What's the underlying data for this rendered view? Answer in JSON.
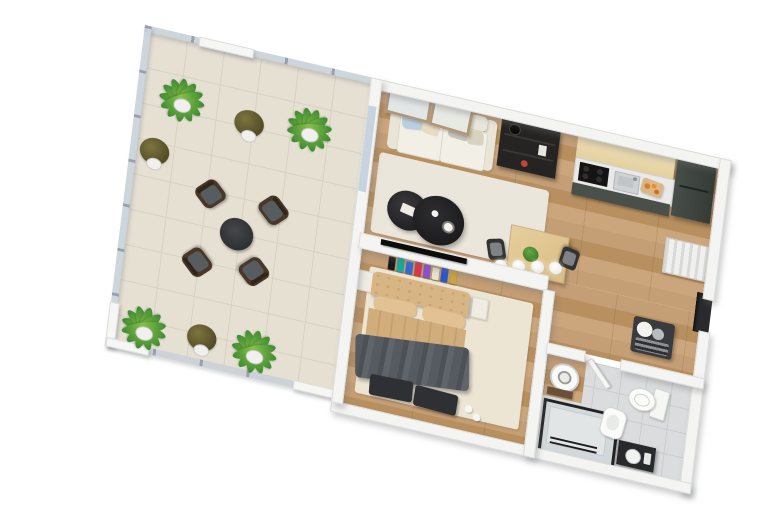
{
  "scene": {
    "kind": "3d-floor-plan-render",
    "view": "isometric top-down, plan rotated ~13 degrees clockwise",
    "background": "#ffffff",
    "no_visible_text": true
  },
  "palette": {
    "wall_white": "#f4f4f2",
    "terrace_tile": "#e6e0d3",
    "glass_railing": "#c9d1d9",
    "railing_post": "#97a1ab",
    "wood_floor": "#c09a6f",
    "bath_tile": "#dadcdd",
    "sofa_cream": "#f2efe7",
    "pillow_blue": "#b9cfdd",
    "rug_light": "#eae6db",
    "coffee_table_black": "#2a2a2c",
    "kitchen_upper_wood": "#ead9ad",
    "kitchen_cabinet_green": "#49504a",
    "fridge_dark": "#3c423d",
    "dining_wood": "#e0c794",
    "bed_tan": "#d5b081",
    "blanket_gray": "#565b61",
    "fixture_white": "#fafafa",
    "vanity_dark": "#28292b",
    "plant_green": "#4e9b3e",
    "accent_food_orange": "#e07a2a"
  },
  "rooms": {
    "terrace": {
      "label": "Terrace",
      "floor": "beige tile",
      "enclosure": "glass railing with metal posts and white wall stubs",
      "furniture": [
        "4 large green potted plants",
        "3 small brown potted plants",
        "4 dark wicker armchairs with gray cushions",
        "round black coffee table"
      ]
    },
    "living": {
      "label": "Living room",
      "floor": "oak wood planks",
      "furniture": [
        "cream 2-seat sofa with blue, cream, gray and beige pillows",
        "two round black coffee tables with decor",
        "dark media shelf unit",
        "wall-mounted TV",
        "two framed artworks",
        "light area rug",
        "sliding glass door to terrace"
      ]
    },
    "kitchen": {
      "label": "Kitchen",
      "furniture": [
        "light-wood tall cabinets",
        "counter with black cooktop and steel sink",
        "cutting board with food",
        "dark green base cabinets",
        "tall dark fridge cabinet"
      ]
    },
    "dining": {
      "label": "Dining area",
      "furniture": [
        "square light-wood table",
        "two dark chairs with gray seats",
        "small green table plant",
        "four white globe pendant lights"
      ]
    },
    "hall": {
      "label": "Entry hall",
      "furniture": [
        "white wall radiator",
        "dark entry door recess",
        "bench with white pillows and striped throw"
      ]
    },
    "bedroom": {
      "label": "Bedroom",
      "furniture": [
        "double bed with quilted tan headboard and tan duvet",
        "dark gray throw blanket",
        "two dark foot benches",
        "two light nightstands",
        "cream rug",
        "wall shelf with colorful books"
      ]
    },
    "bathroom": {
      "label": "Bathroom",
      "furniture": [
        "glass shower with black frame",
        "white boiler",
        "toilet",
        "bidet",
        "dark vanity with round basin",
        "open white door"
      ]
    }
  }
}
